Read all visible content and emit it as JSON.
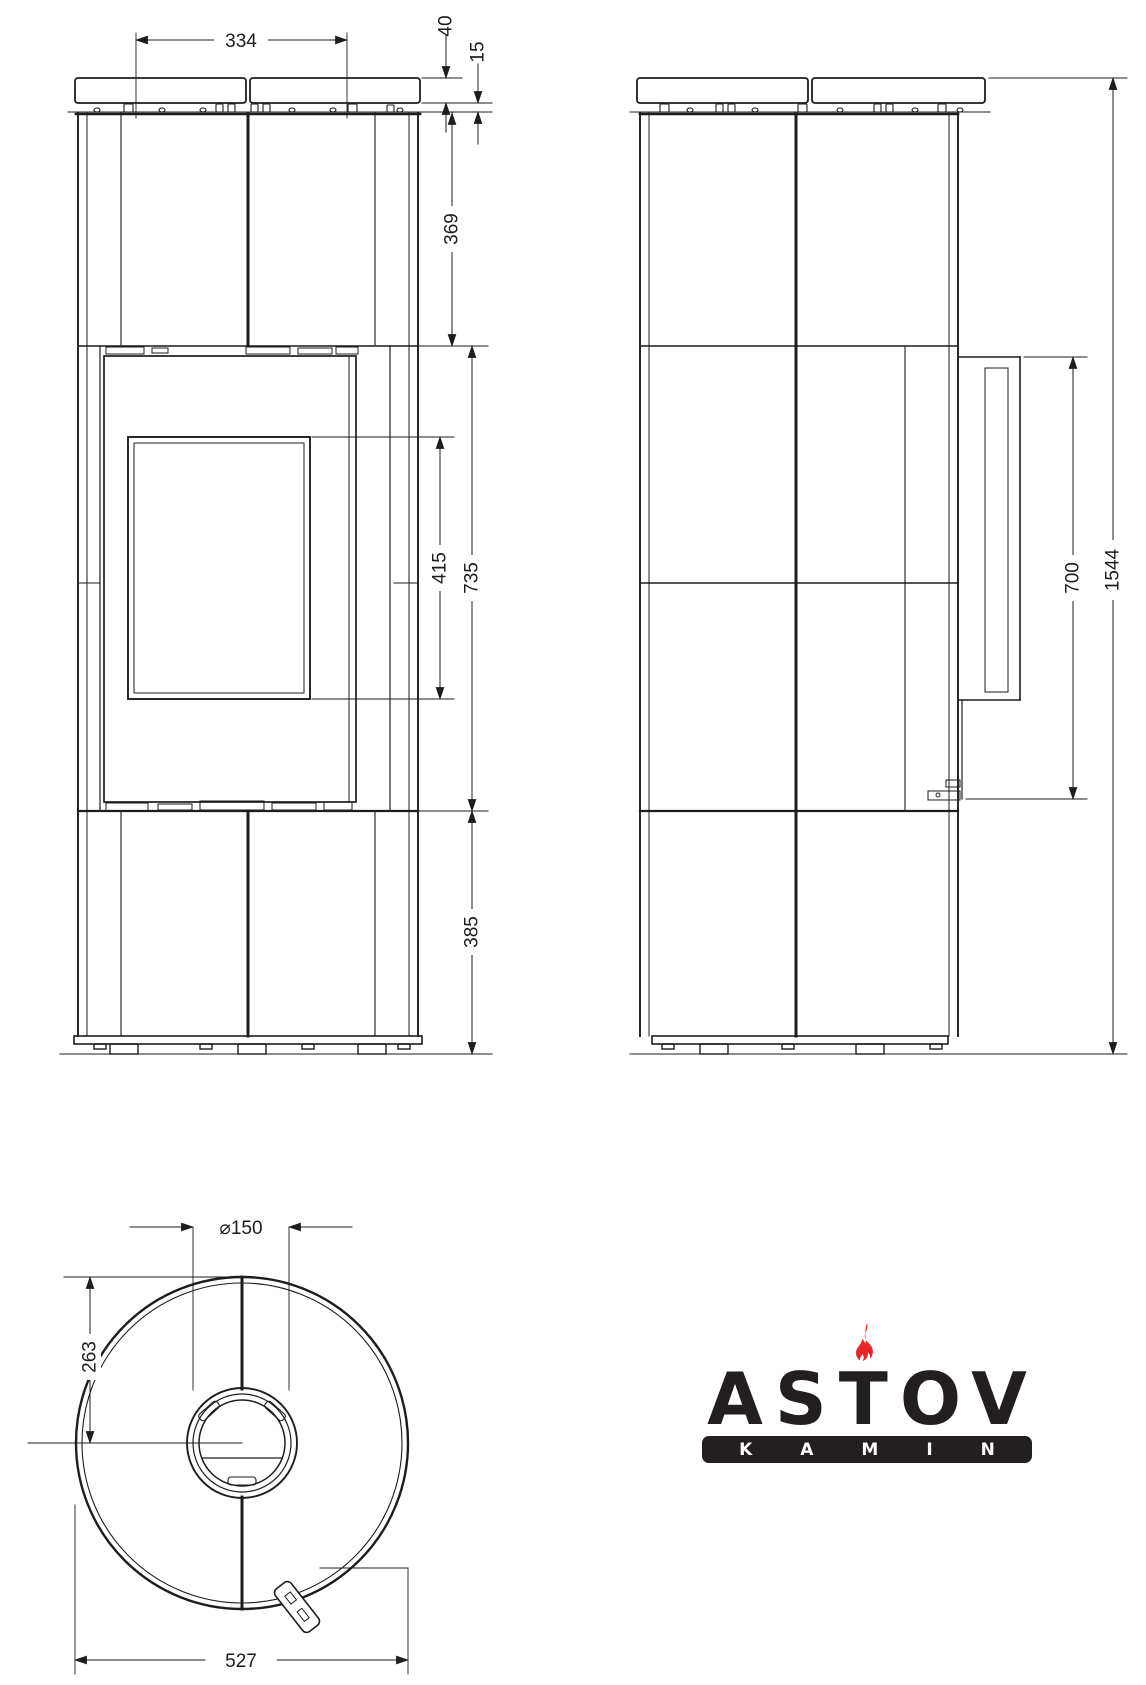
{
  "front_view": {
    "top_plate_width": "334",
    "plate_thickness": "40",
    "plate_clearance": "15",
    "upper_body_height": "369",
    "glass_height": "415",
    "door_section_height": "735",
    "base_section_height": "385"
  },
  "side_view": {
    "door_height": "700",
    "total_height": "1544"
  },
  "top_view": {
    "flue_diameter": "⌀150",
    "back_to_flue_center": "263",
    "body_diameter": "527"
  },
  "logo": {
    "brand": "ASTOV",
    "subtitle": "KAMIN"
  },
  "colors": {
    "line": "#1d1d1b",
    "flame_red": "#e8252b",
    "logo_dark": "#231f20"
  }
}
